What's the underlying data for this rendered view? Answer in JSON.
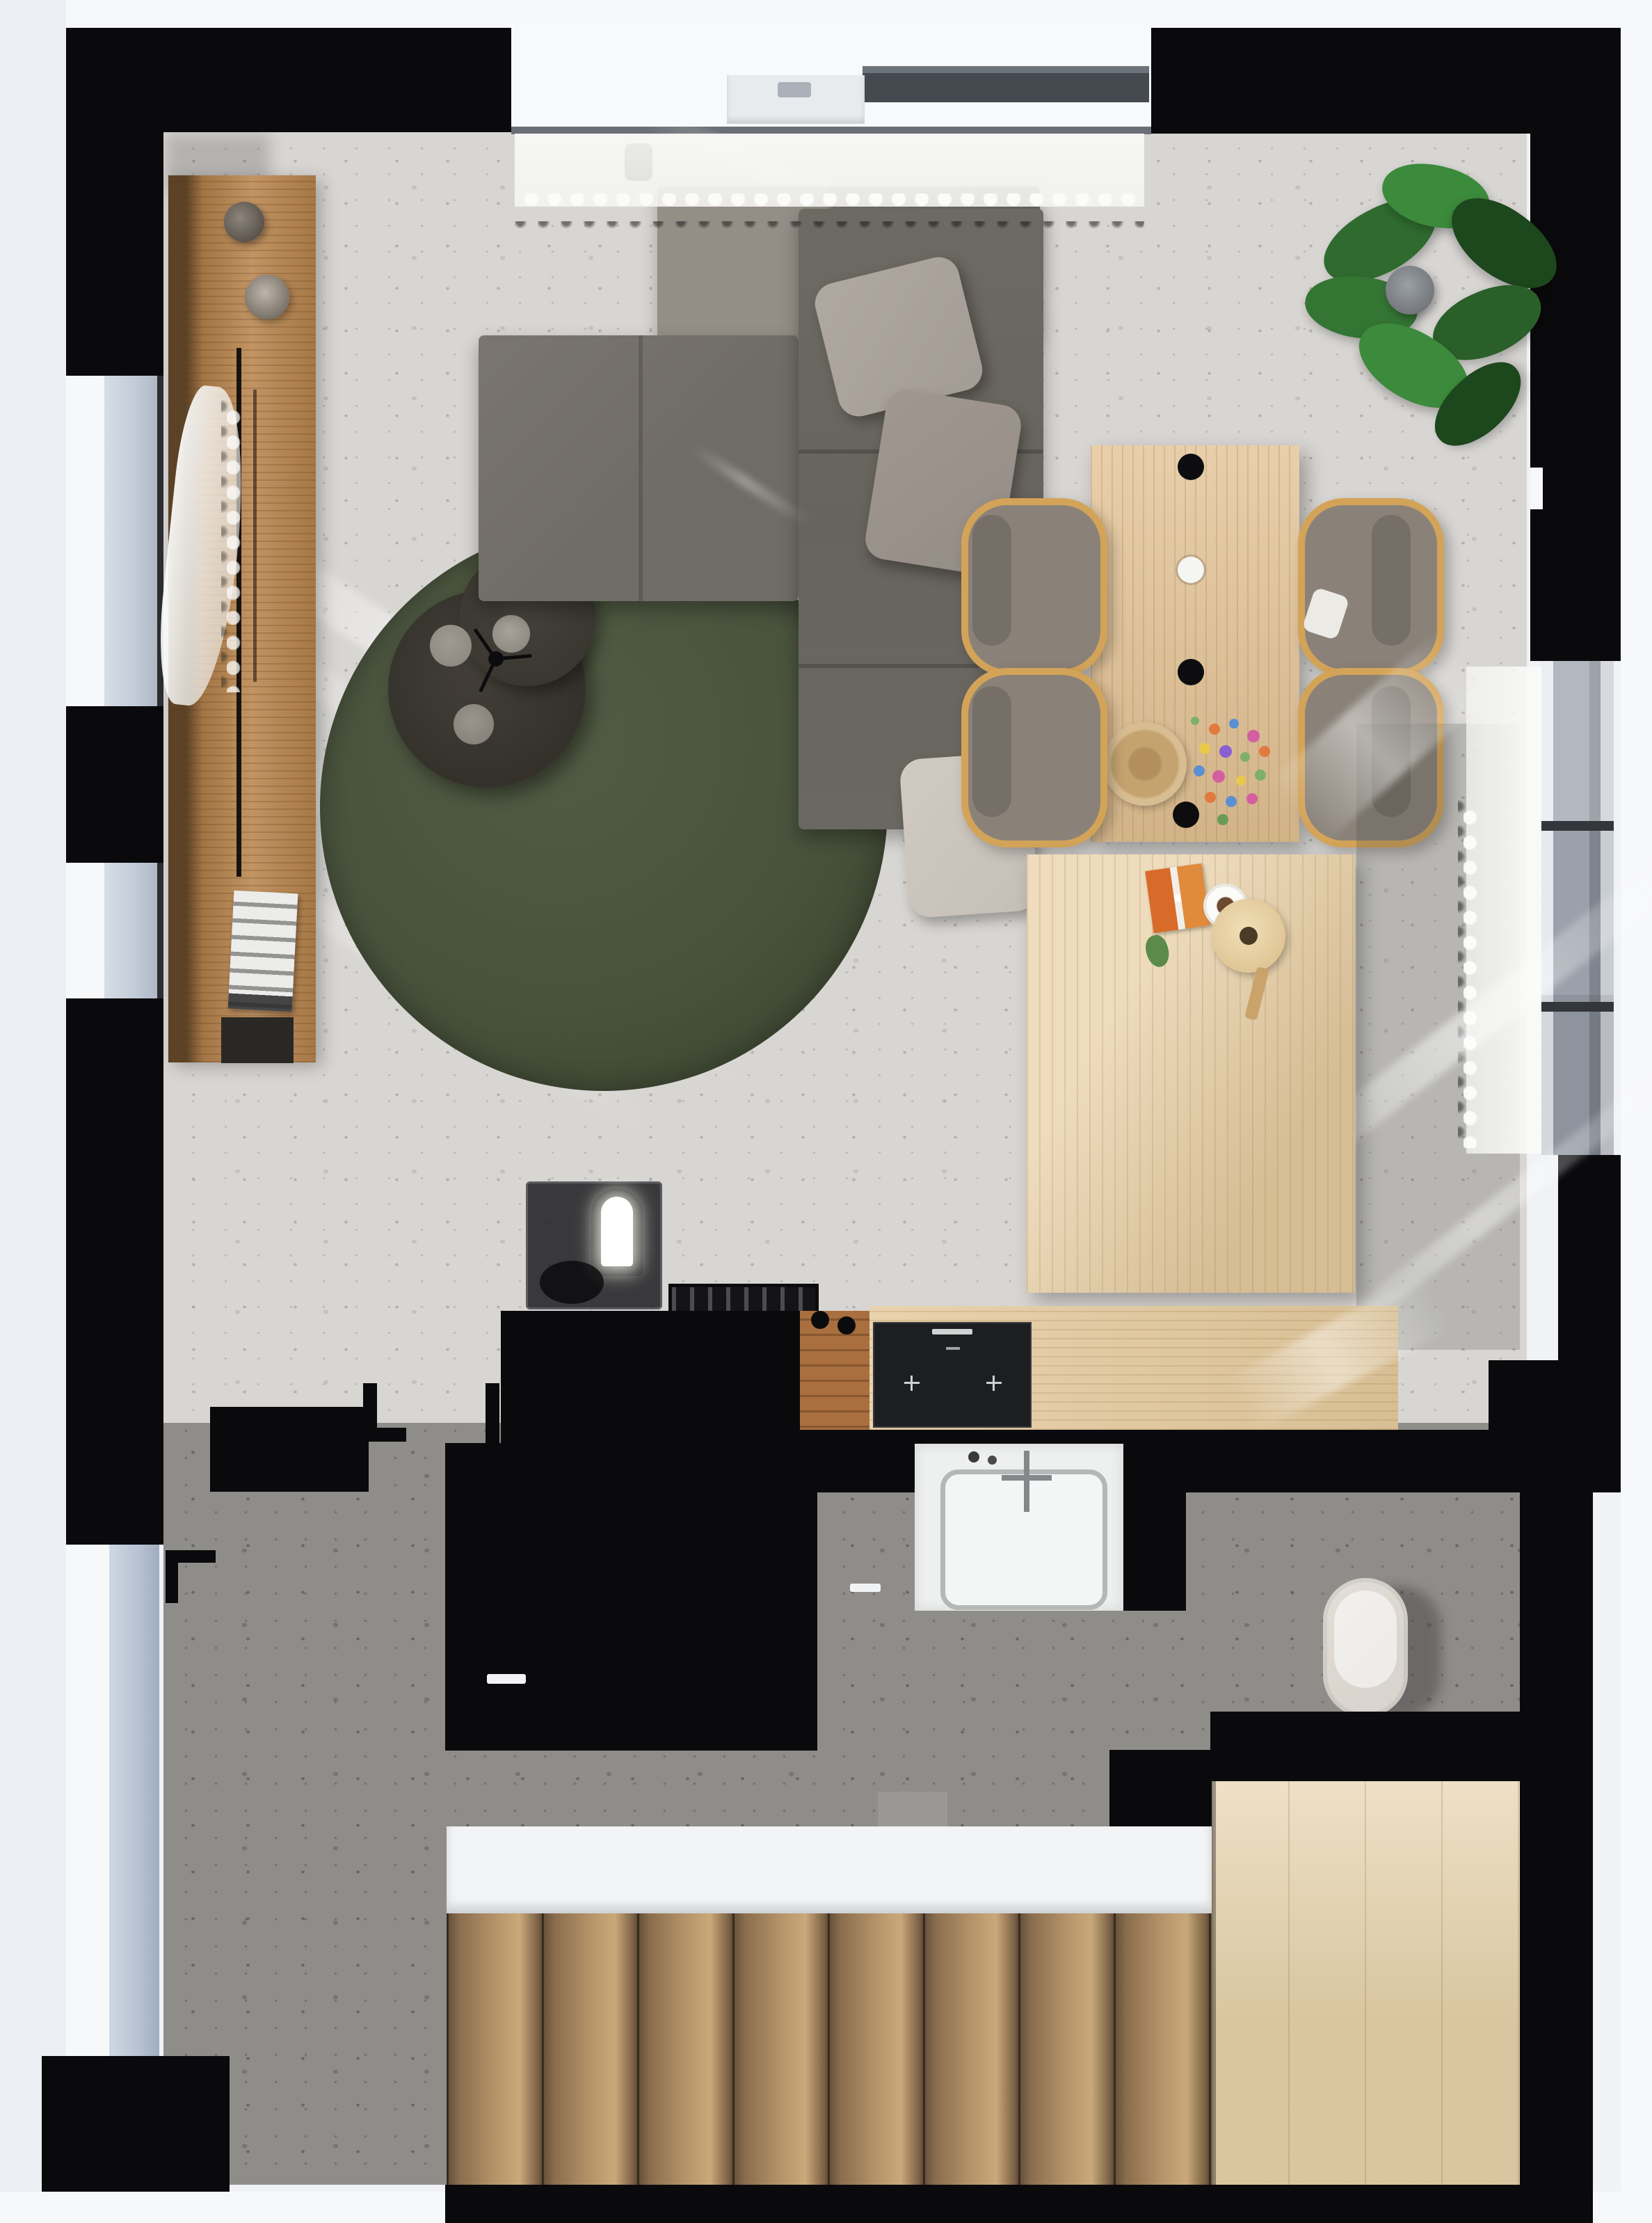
{
  "scene": {
    "type": "3d-floor-plan-render",
    "view": "top-down",
    "description": "Photorealistic top-down 3D render of a small apartment: living room with gray L-shaped sectional sofa on a round dark-green rug, black round coffee tables, wooden sideboard along the left wall, light-oak dining table with four bentwood chairs and pendant lights, potted plant in the corner, black kitchen cabinets and island with oak counter and cooktop, bathroom with white washbasin and wall-hung toilet, dark hallway and a wooden staircase descending at the bottom."
  },
  "rooms": {
    "living_room": "Living room",
    "dining_area": "Dining area",
    "kitchen": "Kitchen",
    "bathroom": "Bathroom",
    "hallway": "Hallway",
    "staircase": "Staircase"
  },
  "palette": {
    "wall": "#0a0a0c",
    "white": "#f7f8fa",
    "floor_light": "#d8d6d3",
    "floor_dark": "#8f8d8a",
    "glass": "#c3ccd8",
    "glass_door": "#b7c2d2",
    "frame_gray": "#9aa1ab",
    "wood_console": "#b9854e",
    "wood_table": "#e2c193",
    "wood_desk": "#e7cda1",
    "wood_counter": "#e3c89b",
    "wood_floor_strip": "#a96f3f",
    "stair_dark": "#5f4c37",
    "stair_light": "#c9a97a",
    "landing": "#e4d0a8",
    "rug_green": "#48523c",
    "sofa": "#6f6b65",
    "sofa_light": "#948e87",
    "pillow1": "#a39c94",
    "pillow2": "#948d85",
    "pillow3": "#c5bfb7",
    "chair_seat": "#8a8279",
    "chair_frame": "#d3a358",
    "table_dark": "#34312b",
    "plate": "#8f8983",
    "plant_green": "#2f6b2f",
    "plant_dark": "#1d471d",
    "pot": "#75787c",
    "curtain": "#f4f4f2",
    "cooktop": "#1d1e21",
    "sink_white": "#eef0ef",
    "toilet": "#d9d5ce",
    "bowl": "#d9bd92"
  },
  "objects": {
    "walls": {
      "label": "Black wall structure"
    },
    "window_top": {
      "label": "Top sliding glass door with frame and handle"
    },
    "window_left_1": {
      "label": "Left facade window (upper)"
    },
    "window_left_2": {
      "label": "Left facade window (lower)"
    },
    "door_left": {
      "label": "Glazed side door"
    },
    "window_right": {
      "label": "Right facade window"
    },
    "curtain_top": {
      "label": "White sheer curtain (top window)"
    },
    "curtain_left": {
      "label": "Billowing sheer curtain (left window)"
    },
    "curtain_right": {
      "label": "White sheer curtain (right window)"
    },
    "sunlight": {
      "label": "Sunlight streaks on the floor"
    },
    "console": {
      "label": "Wooden sideboard with decor"
    },
    "vases": {
      "label": "Decorative vases"
    },
    "magazine": {
      "label": "Magazine stack"
    },
    "sofa": {
      "label": "Gray L-shaped sectional sofa"
    },
    "pillows": {
      "label": "Sofa cushions"
    },
    "rug": {
      "label": "Round dark-green rug"
    },
    "coffee_table": {
      "label": "Black round nesting coffee tables with trays"
    },
    "dining_table": {
      "label": "Light oak dining table"
    },
    "chairs": {
      "label": "Upholstered dining chairs with bentwood frames"
    },
    "pendants": {
      "label": "Pendant lights above the dining table"
    },
    "bowl": {
      "label": "Wooden serving bowl"
    },
    "flowers": {
      "label": "Wildflower bouquet"
    },
    "plant": {
      "label": "Potted green plant"
    },
    "desk": {
      "label": "Low oak table"
    },
    "game_board": {
      "label": "Card game box"
    },
    "cup": {
      "label": "Coffee cup on saucer"
    },
    "guitar": {
      "label": "Wooden toy guitar"
    },
    "side_table": {
      "label": "Smoked-glass side table"
    },
    "lamp": {
      "label": "Arched glowing table lamp"
    },
    "dish_rack": {
      "label": "Black dish tray"
    },
    "kitchen_counter_black": {
      "label": "Black kitchen counter"
    },
    "kitchen_island": {
      "label": "Black kitchen island with handle"
    },
    "wood_counter": {
      "label": "Oak kitchen worktop"
    },
    "cooktop": {
      "label": "Black induction cooktop"
    },
    "stools": {
      "label": "Black counter knobs"
    },
    "vanity": {
      "label": "Bathroom vanity"
    },
    "sink": {
      "label": "White washbasin with cross faucet"
    },
    "toilet": {
      "label": "Wall-hung toilet"
    },
    "stairs": {
      "label": "Wooden staircase"
    },
    "landing": {
      "label": "Wooden stair landing"
    },
    "door_marks": {
      "label": "Door swing jamb marks"
    }
  }
}
